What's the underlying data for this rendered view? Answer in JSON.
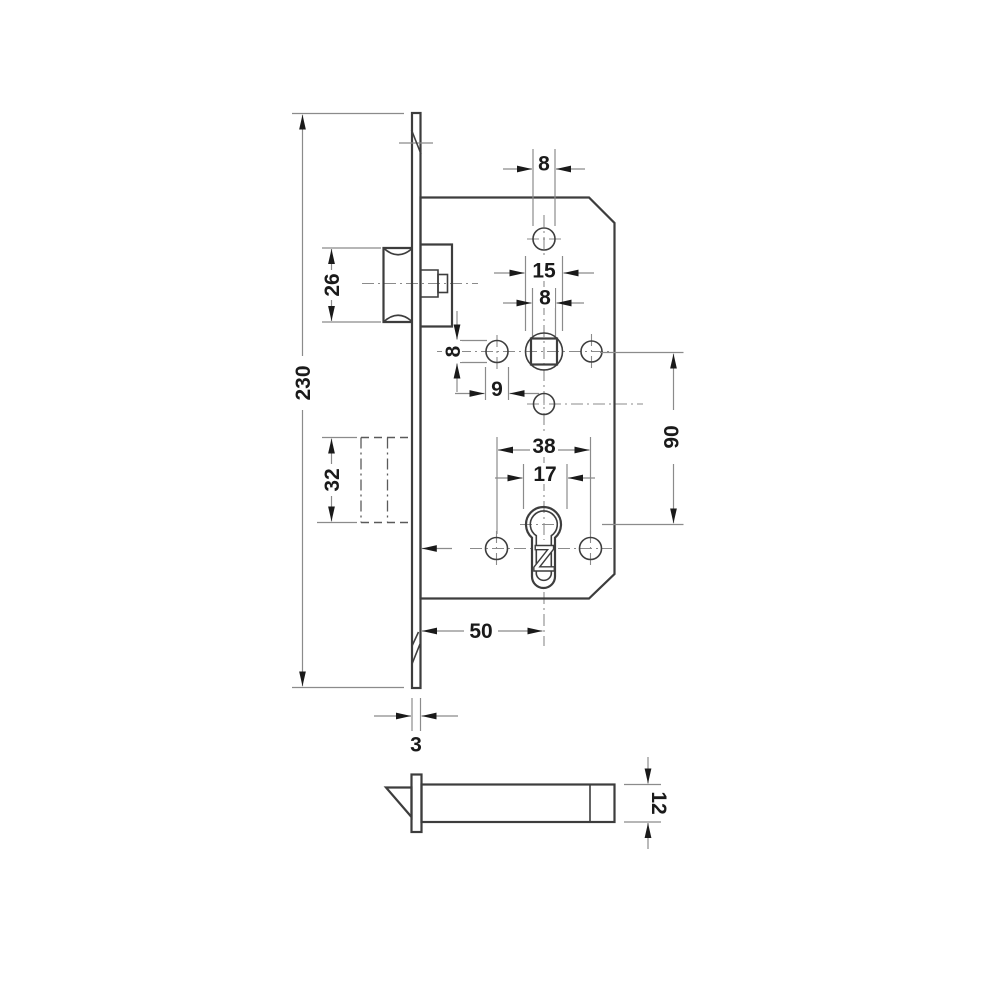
{
  "drawing": {
    "kind": "technical-drawing-mortise-lock",
    "dims": {
      "overall_height": "230",
      "latch_height": "26",
      "deadbolt_height": "32",
      "top_hole_diameter": "8",
      "follower_diameter": "15",
      "spindle_square_size": "8",
      "side_hole_height": "8",
      "side_hole_width": "9",
      "cylinder_hole_spacing": "38",
      "cylinder_width": "17",
      "handle_to_cylinder_distance": "90",
      "backset": "50",
      "faceplate_thickness": "3",
      "case_depth": "12"
    },
    "cylinder_mark": "Z",
    "colors": {
      "object_line": "#3d3d3d",
      "dimension_line": "#8b8b8b",
      "text": "#1a1a1a",
      "background": "#ffffff"
    }
  }
}
